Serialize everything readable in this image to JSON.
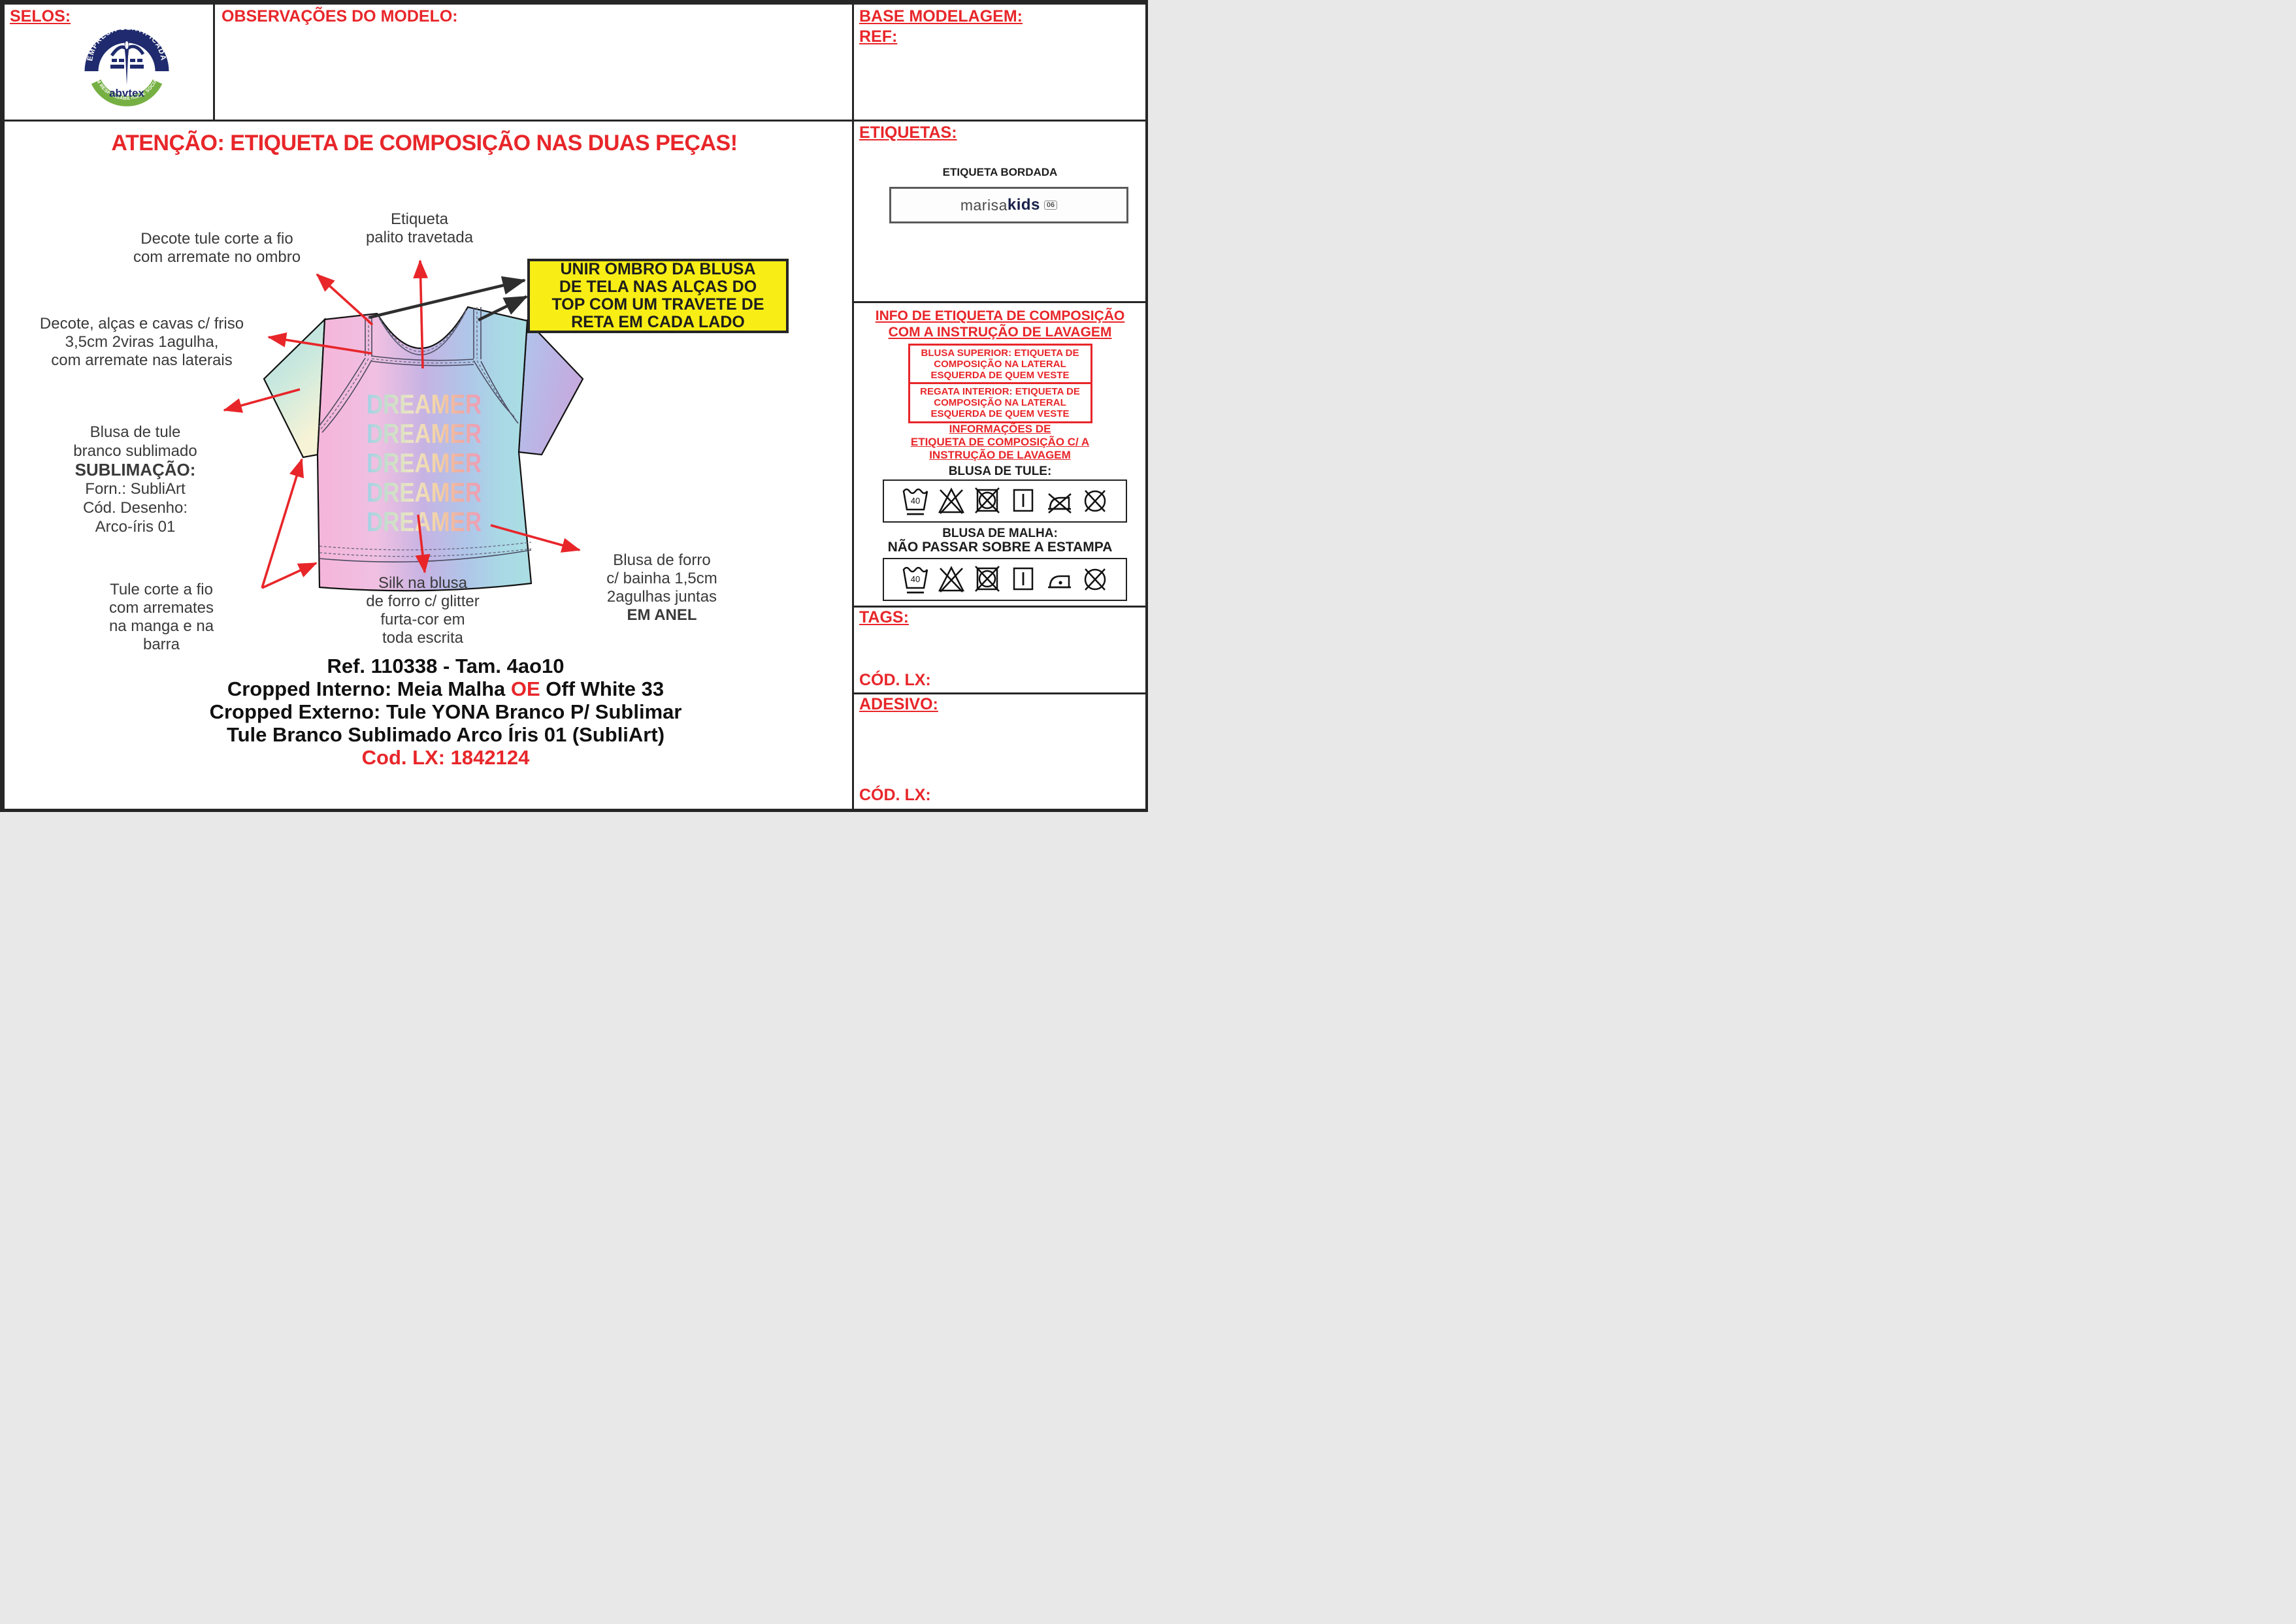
{
  "colors": {
    "accent_red": "#E8262A",
    "note_yellow": "#F8EE15",
    "logo_navy": "#1F2B6E",
    "logo_green": "#76B043"
  },
  "header": {
    "selos_label": "SELOS:",
    "observacoes_label": "OBSERVAÇÕES DO MODELO:",
    "base_modelagem_label": "BASE MODELAGEM:",
    "ref_label": "REF:",
    "logo": {
      "arc_top": "EMPRESA CERTIFICADA",
      "arc_bottom": "EM RESPONSABILIDADE SOCIAL",
      "brand": "abvtex"
    }
  },
  "main": {
    "attention": "ATENÇÃO: ETIQUETA DE COMPOSIÇÃO NAS DUAS PEÇAS!",
    "annotations": {
      "etiqueta_palito": {
        "lines": [
          "Etiqueta",
          "palito travetada"
        ]
      },
      "decote_tule": {
        "lines": [
          "Decote tule corte a fio",
          "com arremate no ombro"
        ]
      },
      "decote_friso": {
        "lines": [
          "Decote, alças e cavas c/ friso",
          "3,5cm 2viras 1agulha,",
          "com arremate nas laterais"
        ]
      },
      "blusa_tule": {
        "lines": [
          "Blusa de tule",
          "branco sublimado",
          "SUBLIMAÇÃO:",
          "Forn.: SubliArt",
          "Cód. Desenho:",
          "Arco-íris 01"
        ]
      },
      "tule_corte": {
        "lines": [
          "Tule corte a fio",
          "com arremates",
          "na manga e na",
          "barra"
        ]
      },
      "silk": {
        "lines": [
          "Silk na blusa",
          "de forro c/ glitter",
          "furta-cor em",
          "toda escrita"
        ]
      },
      "blusa_forro": {
        "lines": [
          "Blusa de forro",
          "c/ bainha 1,5cm",
          "2agulhas juntas",
          "EM ANEL"
        ]
      }
    },
    "yellow_note": {
      "lines": [
        "UNIR OMBRO DA BLUSA",
        "DE TELA NAS ALÇAS DO",
        "TOP COM UM TRAVETE DE",
        "RETA EM CADA LADO"
      ]
    },
    "shirt": {
      "print_word": "DREAMER",
      "print_rows": 5
    },
    "bottom_block": {
      "line1": "Ref. 110338 - Tam. 4ao10",
      "line2_prefix": "Cropped Interno: Meia Malha ",
      "line2_red": "OE",
      "line2_suffix": " Off White 33",
      "line3": "Cropped Externo: Tule YONA Branco P/ Sublimar",
      "line4": "Tule Branco Sublimado Arco Íris 01 (SubliArt)",
      "line5": "Cod. LX: 1842124"
    }
  },
  "sidebar": {
    "etiquetas_label": "ETIQUETAS:",
    "etiqueta_bordada": "ETIQUETA BORDADA",
    "brand": {
      "part1": "marisa",
      "part2": "kids",
      "badge": "06"
    },
    "info_header": {
      "lines": [
        "INFO DE ETIQUETA DE COMPOSIÇÃO",
        "COM A INSTRUÇÃO DE LAVAGEM"
      ]
    },
    "box_superior": {
      "lines": [
        "BLUSA SUPERIOR: ETIQUETA DE",
        "COMPOSIÇÃO NA LATERAL",
        "ESQUERDA DE QUEM VESTE"
      ]
    },
    "box_regata": {
      "lines": [
        "REGATA INTERIOR: ETIQUETA DE",
        "COMPOSIÇÃO NA LATERAL",
        "ESQUERDA DE QUEM VESTE"
      ]
    },
    "informacoes": {
      "lines": [
        "INFORMAÇÕES DE",
        "ETIQUETA DE COMPOSIÇÃO C/ A",
        "INSTRUÇÃO DE LAVAGEM"
      ]
    },
    "blusa_tule_label": "BLUSA DE TULE:",
    "blusa_malha_label": "BLUSA DE MALHA:",
    "nao_passar": "NÃO PASSAR SOBRE A ESTAMPA",
    "care_row1": [
      "wash-40",
      "no-bleach",
      "no-tumble-dry",
      "line-dry",
      "no-iron",
      "no-dry-clean"
    ],
    "care_row2": [
      "wash-40",
      "no-bleach",
      "no-tumble-dry",
      "line-dry",
      "iron-low",
      "no-dry-clean"
    ],
    "tags_label": "TAGS:",
    "cod_lx_label": "CÓD. LX:",
    "adesivo_label": "ADESIVO:",
    "cod_lx2_label": "CÓD. LX:"
  }
}
